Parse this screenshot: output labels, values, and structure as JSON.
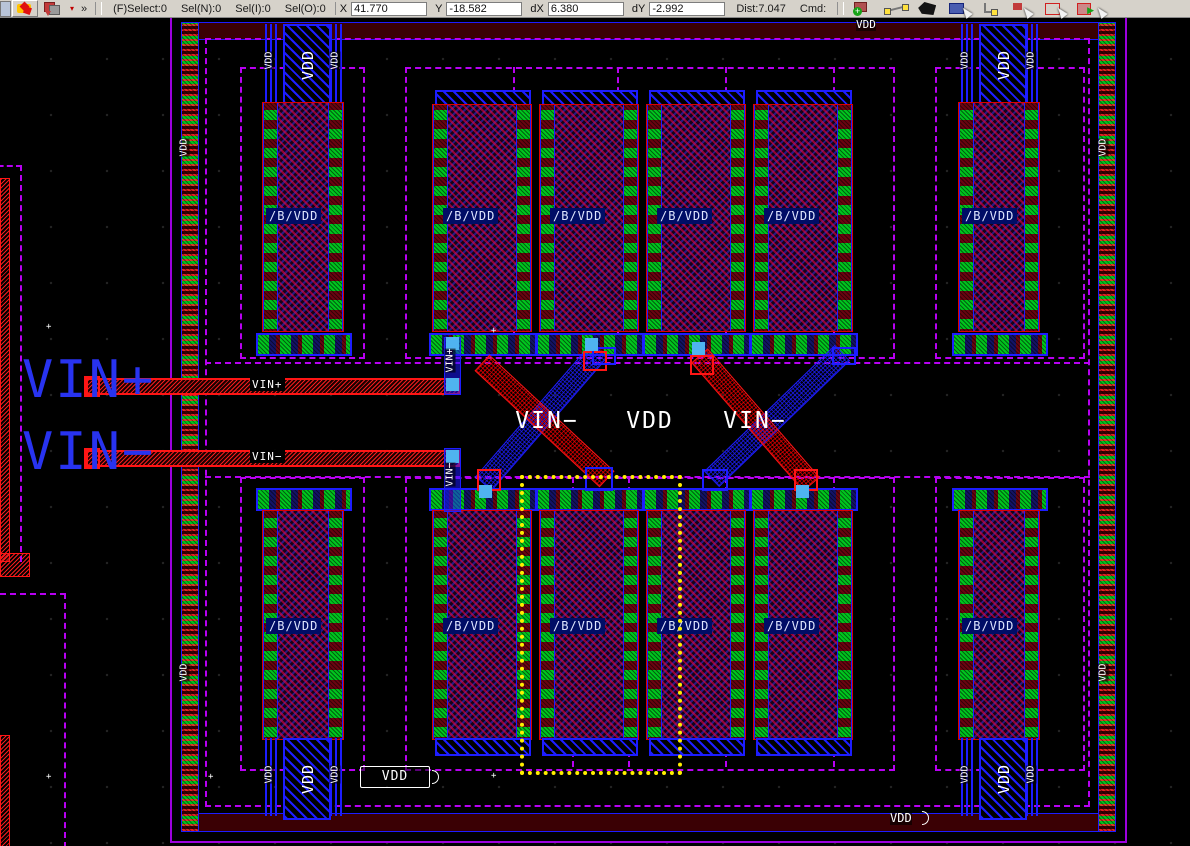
{
  "toolbar": {
    "status": {
      "select": "(F)Select:0",
      "sel_n": "Sel(N):0",
      "sel_i": "Sel(I):0",
      "sel_o": "Sel(O):0"
    },
    "coords": {
      "x_label": "X",
      "x": "41.770",
      "y_label": "Y",
      "y": "-18.582",
      "dx_label": "dX",
      "dx": "6.380",
      "dy_label": "dY",
      "dy": "-2.992",
      "dist": "Dist:7.047",
      "cmd_label": "Cmd:"
    },
    "overflow_glyph": "»",
    "dropdown_glyph": "▾",
    "icons": [
      "burst-icon",
      "layers-icon",
      "dropdown-icon",
      "overflow-icon",
      "create-instance-icon",
      "ruler-icon",
      "create-polygon-icon",
      "create-rectangle-icon",
      "create-path-icon",
      "select-icon",
      "area-select-icon",
      "stretch-icon"
    ]
  },
  "labels": {
    "block": "/B/VDD",
    "vdd": "VDD",
    "vin_plus": "VIN+",
    "vin_minus": "VIN−",
    "big_vin_plus": "VIN+",
    "big_vin_minus": "VIN−",
    "center_left": "VIN−",
    "center_mid": "VDD",
    "center_right": "VIN−"
  },
  "colors": {
    "boundary_dashed": "#b800f2",
    "boundary_solid": "#9d00dd",
    "metal_blue": "#1d1dff",
    "poly_red": "#ff1515",
    "contact_green": "#00c41e",
    "via_cyan": "#4fb3f0",
    "selection_yellow": "#ffee00",
    "device_fill": "#14031c",
    "label_white": "#ffffff",
    "label_blue": "#2833f0",
    "toolbar_bg": "#d6d2ca"
  }
}
